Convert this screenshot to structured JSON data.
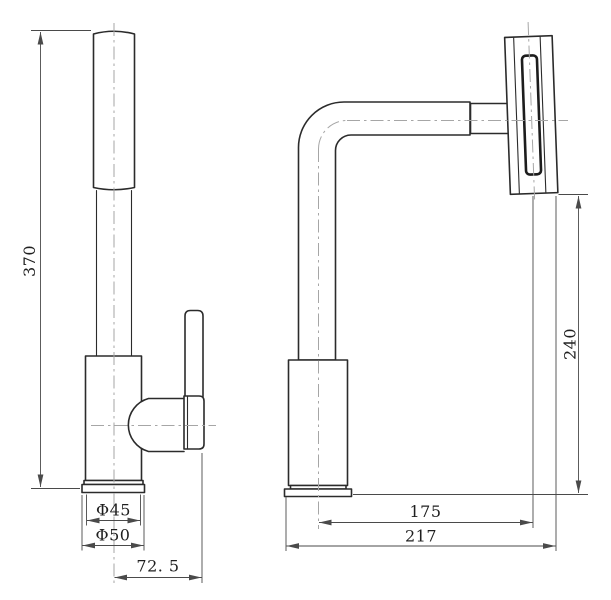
{
  "drawing": {
    "title": "faucet-two-view-dimension-drawing",
    "views": {
      "front": "front-view-faucet",
      "side": "side-view-faucet"
    },
    "dimensions": {
      "overall_height": "370",
      "body_diameter": "Φ45",
      "base_diameter": "Φ50",
      "handle_offset": "72. 5",
      "spout_height": "240",
      "spout_reach": "175",
      "overall_depth": "217"
    },
    "colors": {
      "background": "#ffffff",
      "outline": "#2b2b2b",
      "dimension": "#4a4a4a",
      "centerline": "#a6a6a6"
    }
  }
}
